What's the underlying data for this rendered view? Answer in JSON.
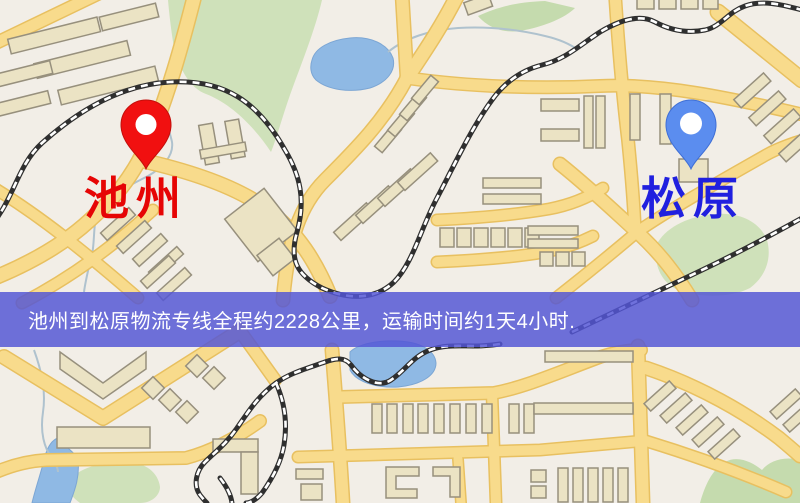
{
  "route": {
    "origin": {
      "name": "池州",
      "pin_color": "#f11010",
      "label_color": "#e60505"
    },
    "destination": {
      "name": "松原",
      "pin_color": "#5b8def",
      "label_color": "#2020df"
    },
    "distance_km": "2228",
    "duration": "1天4小时"
  },
  "banner": {
    "text": "池州到松原物流专线全程约2228公里，运输时间约1天4小时.",
    "background_color": "#5456d5",
    "text_color": "#ffffff"
  },
  "map": {
    "colors": {
      "land": "#f2eee7",
      "road": "#f8db8c",
      "road_casing": "#e8c060",
      "water": "#8fb9e4",
      "park": "#cfe1ba",
      "building": "#ebe3c4",
      "building_outline": "#97907d",
      "railway": "#2f2f2f"
    }
  }
}
